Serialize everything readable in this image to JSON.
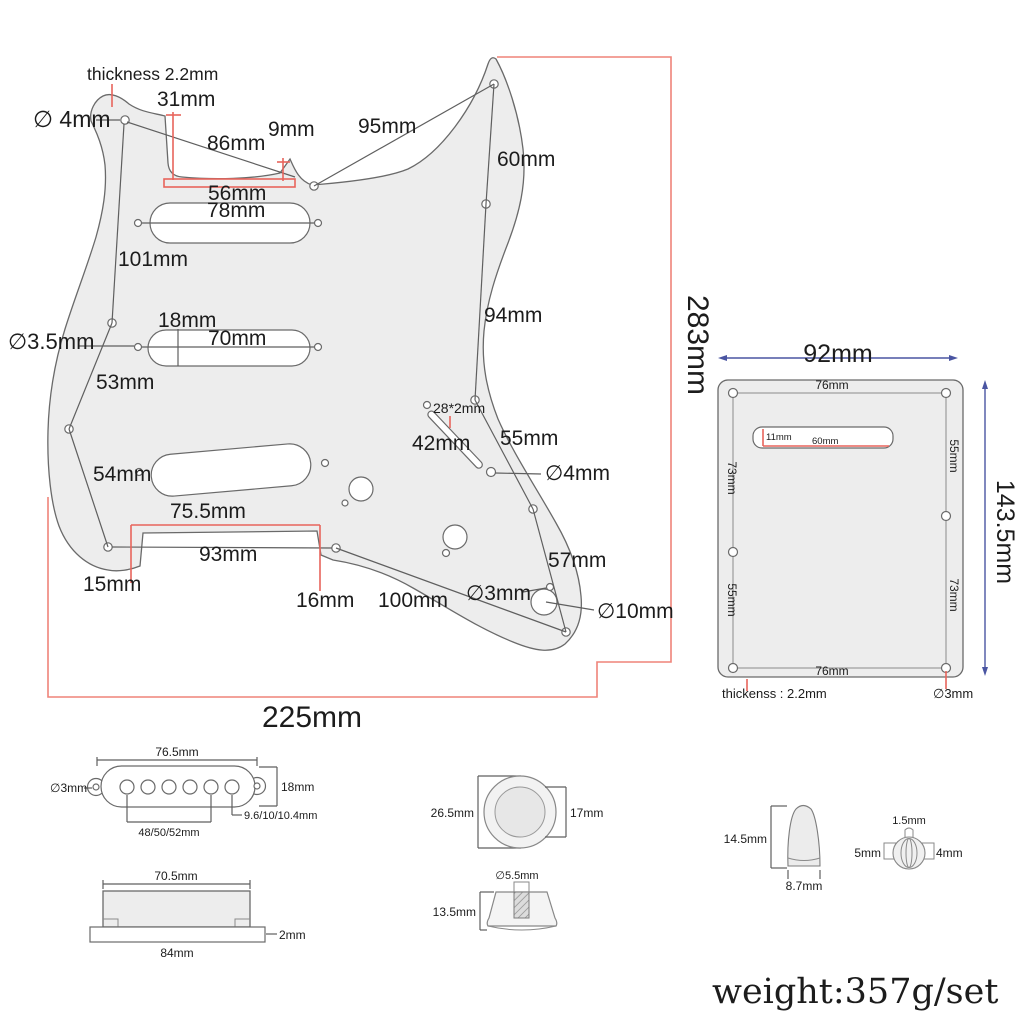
{
  "pickguard": {
    "thickness": "thickness 2.2mm",
    "hole_top": "∅ 4mm",
    "d31": "31mm",
    "d9": "9mm",
    "d95": "95mm",
    "d86": "86mm",
    "d56": "56mm",
    "d78": "78mm",
    "d60": "60mm",
    "d101": "101mm",
    "d94": "94mm",
    "hole_35": "∅3.5mm",
    "d18": "18mm",
    "d70": "70mm",
    "d53": "53mm",
    "d54": "54mm",
    "d28x2": "28*2mm",
    "d42": "42mm",
    "d55": "55mm",
    "hole_4": "∅4mm",
    "d755": "75.5mm",
    "d93": "93mm",
    "d15": "15mm",
    "d16": "16mm",
    "d100": "100mm",
    "d57": "57mm",
    "hole_3": "∅3mm",
    "hole_10": "∅10mm",
    "width": "225mm",
    "height": "283mm"
  },
  "backplate": {
    "width": "92mm",
    "height": "143.5mm",
    "top": "76mm",
    "bottom": "76mm",
    "slot_h": "11mm",
    "slot_w": "60mm",
    "left_up": "73mm",
    "left_low": "55mm",
    "right_up": "55mm",
    "right_low": "73mm",
    "thickness": "thickenss : 2.2mm",
    "hole": "∅3mm"
  },
  "pickup_top": {
    "width": "76.5mm",
    "hole": "∅3mm",
    "height": "18mm",
    "pole_d": "9.6/10/10.4mm",
    "span": "48/50/52mm"
  },
  "pickup_side": {
    "top": "70.5mm",
    "lip": "2mm",
    "base": "84mm"
  },
  "knob_top": {
    "outer": "26.5mm",
    "inner": "17mm"
  },
  "knob_side": {
    "shaft": "∅5.5mm",
    "height": "13.5mm"
  },
  "switch_tip": {
    "height": "14.5mm",
    "width": "8.7mm"
  },
  "barrel": {
    "tip": "1.5mm",
    "left": "5mm",
    "right": "4mm"
  },
  "weight": "weight:357g/set",
  "colors": {
    "line": "#5f5f5f",
    "dim_red": "#e8645c",
    "dim_blue": "#4a55a2",
    "fill": "#ededed"
  }
}
